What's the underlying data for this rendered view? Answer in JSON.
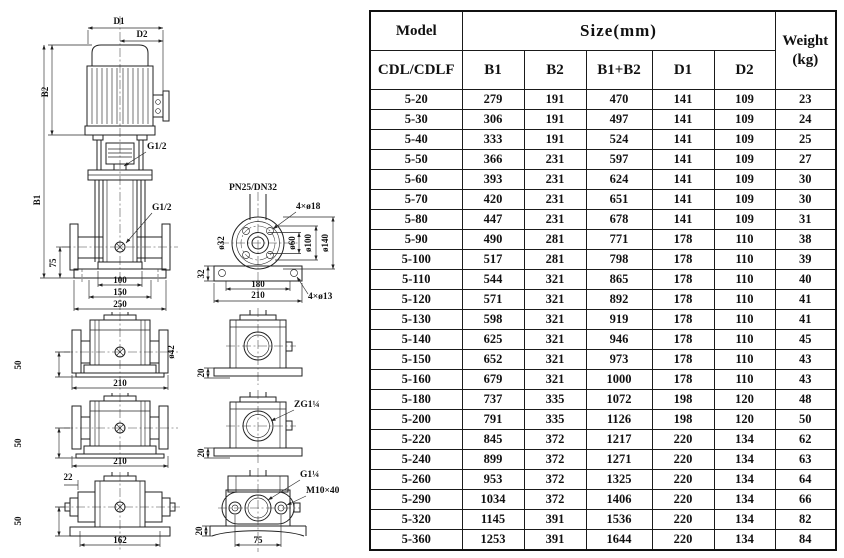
{
  "table": {
    "header": {
      "model": "Model",
      "model_sub": "CDL/CDLF",
      "size_group": "Size(mm)",
      "size_cols": [
        "B1",
        "B2",
        "B1+B2",
        "D1",
        "D2"
      ],
      "weight_line1": "Weight",
      "weight_line2": "(kg)"
    },
    "rows": [
      [
        "5-20",
        "279",
        "191",
        "470",
        "141",
        "109",
        "23"
      ],
      [
        "5-30",
        "306",
        "191",
        "497",
        "141",
        "109",
        "24"
      ],
      [
        "5-40",
        "333",
        "191",
        "524",
        "141",
        "109",
        "25"
      ],
      [
        "5-50",
        "366",
        "231",
        "597",
        "141",
        "109",
        "27"
      ],
      [
        "5-60",
        "393",
        "231",
        "624",
        "141",
        "109",
        "30"
      ],
      [
        "5-70",
        "420",
        "231",
        "651",
        "141",
        "109",
        "30"
      ],
      [
        "5-80",
        "447",
        "231",
        "678",
        "141",
        "109",
        "31"
      ],
      [
        "5-90",
        "490",
        "281",
        "771",
        "178",
        "110",
        "38"
      ],
      [
        "5-100",
        "517",
        "281",
        "798",
        "178",
        "110",
        "39"
      ],
      [
        "5-110",
        "544",
        "321",
        "865",
        "178",
        "110",
        "40"
      ],
      [
        "5-120",
        "571",
        "321",
        "892",
        "178",
        "110",
        "41"
      ],
      [
        "5-130",
        "598",
        "321",
        "919",
        "178",
        "110",
        "41"
      ],
      [
        "5-140",
        "625",
        "321",
        "946",
        "178",
        "110",
        "45"
      ],
      [
        "5-150",
        "652",
        "321",
        "973",
        "178",
        "110",
        "43"
      ],
      [
        "5-160",
        "679",
        "321",
        "1000",
        "178",
        "110",
        "43"
      ],
      [
        "5-180",
        "737",
        "335",
        "1072",
        "198",
        "120",
        "48"
      ],
      [
        "5-200",
        "791",
        "335",
        "1126",
        "198",
        "120",
        "50"
      ],
      [
        "5-220",
        "845",
        "372",
        "1217",
        "220",
        "134",
        "62"
      ],
      [
        "5-240",
        "899",
        "372",
        "1271",
        "220",
        "134",
        "63"
      ],
      [
        "5-260",
        "953",
        "372",
        "1325",
        "220",
        "134",
        "64"
      ],
      [
        "5-290",
        "1034",
        "372",
        "1406",
        "220",
        "134",
        "66"
      ],
      [
        "5-320",
        "1145",
        "391",
        "1536",
        "220",
        "134",
        "82"
      ],
      [
        "5-360",
        "1253",
        "391",
        "1644",
        "220",
        "134",
        "84"
      ]
    ]
  },
  "drawing": {
    "front_view": {
      "d1": "D1",
      "d2": "D2",
      "b1": "B1",
      "b2": "B2",
      "g12_top": "G1/2",
      "g12_mid": "G1/2",
      "dim_75": "75",
      "dim_100": "100",
      "dim_150": "150",
      "dim_250": "250"
    },
    "flange_view": {
      "title": "PN25/DN32",
      "bolt_holes": "4×ø18",
      "dia_32": "ø32",
      "dia_60": "ø60",
      "dia_100": "ø100",
      "dia_140": "ø140",
      "dim_32": "32",
      "dim_180": "180",
      "dim_210": "210",
      "base_holes": "4×ø13"
    },
    "side_view_1": {
      "dim_50": "50",
      "dim_210": "210",
      "dia_42": "ø42"
    },
    "side_view_2": {
      "dim_50": "50",
      "dim_210": "210"
    },
    "side_view_3": {
      "dim_22": "22",
      "dim_50": "50",
      "dim_162": "162"
    },
    "section_view_1": {
      "dim_20": "20"
    },
    "section_view_2": {
      "dim_20": "20",
      "port": "ZG1¼"
    },
    "outlet_view": {
      "port": "G1¼",
      "bolt": "M10×40",
      "dim_20": "20",
      "dim_75": "75"
    }
  }
}
